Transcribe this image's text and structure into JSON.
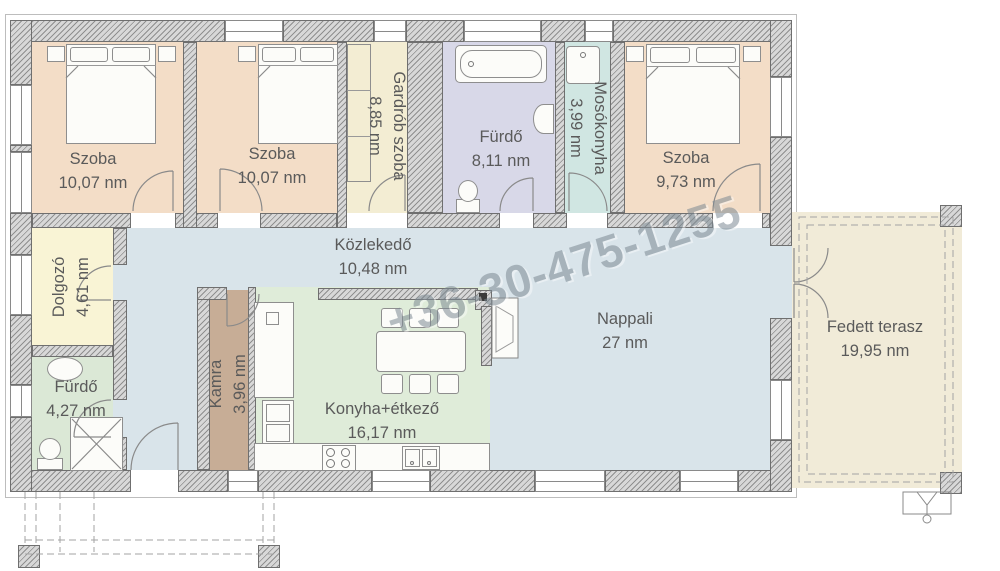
{
  "watermark": "+36-30-475-1255",
  "rooms": {
    "szoba1": {
      "name": "Szoba",
      "area": "10,07 nm"
    },
    "szoba2": {
      "name": "Szoba",
      "area": "10,07 nm"
    },
    "gardrob": {
      "name": "Gardrób szoba",
      "area": "8,85 nm"
    },
    "furdo_top": {
      "name": "Fürdő",
      "area": "8,11 nm"
    },
    "mosokonyha": {
      "name": "Mosókonyha",
      "area": "3,99 nm"
    },
    "szoba3": {
      "name": "Szoba",
      "area": "9,73 nm"
    },
    "dolgozo": {
      "name": "Dolgozó",
      "area": "4,61 nm"
    },
    "furdo_bottom": {
      "name": "Fürdő",
      "area": "4,27 nm"
    },
    "kamra": {
      "name": "Kamra",
      "area": "3,96 nm"
    },
    "konyha": {
      "name": "Konyha+étkező",
      "area": "16,17 nm"
    },
    "kozlekedo": {
      "name": "Közlekedő",
      "area": "10,48 nm"
    },
    "nappali": {
      "name": "Nappali",
      "area": "27 nm"
    },
    "terasz": {
      "name": "Fedett terasz",
      "area": "19,95 nm"
    }
  },
  "colors": {
    "szoba": "#f3ddc7",
    "gardrob": "#f3edd3",
    "furdo_top": "#d8d8e8",
    "mosokonyha": "#d0e6e2",
    "hall": "#d9e4ea",
    "konyha": "#dfecd9",
    "dolgozo": "#f9f4d5",
    "furdo_bottom": "#dbe8d6",
    "kamra": "#c7ad96",
    "terasz": "#f1ebd8",
    "wall_light": "#d8d8d8",
    "wall_dark": "#8f8f8f",
    "line": "#8a8a8a",
    "label": "#5a5a5a",
    "watermark": "#7d8a94"
  }
}
